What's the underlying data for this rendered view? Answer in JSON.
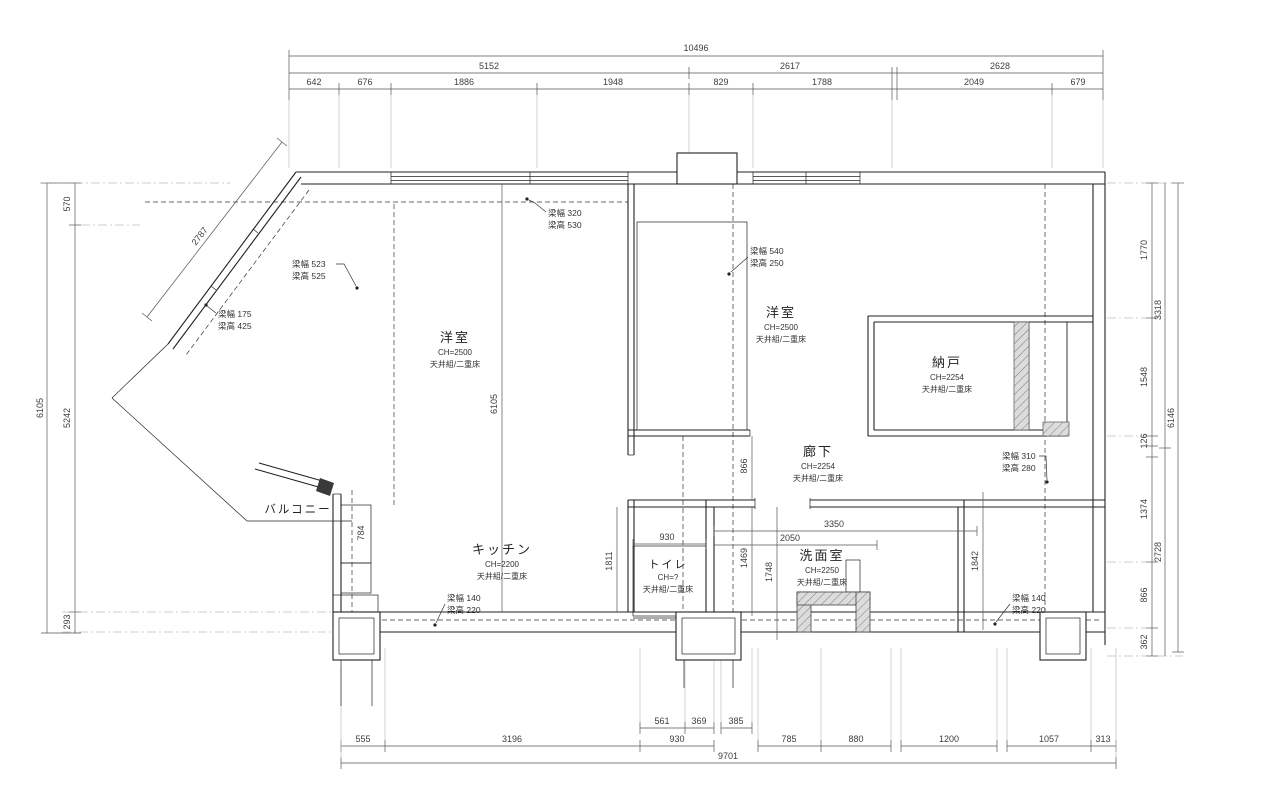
{
  "dims": {
    "top_total": "10496",
    "top2": [
      "5152",
      "2617",
      "2628"
    ],
    "top3": [
      "642",
      "676",
      "1886",
      "1948",
      "829",
      "1788",
      "2049",
      "679"
    ],
    "left_total": "6105",
    "left": [
      "570",
      "5242",
      "293"
    ],
    "right": [
      "1770",
      "1548",
      "126",
      "1374",
      "866",
      "362"
    ],
    "right_mid": [
      "3318",
      "2728"
    ],
    "right_total": "6146",
    "bot_sub": [
      "561",
      "369",
      "385"
    ],
    "bot": [
      "555",
      "3196",
      "930",
      "785",
      "880",
      "1200",
      "1057",
      "313"
    ],
    "bot_total": "9701",
    "interior": {
      "diag": "2787",
      "mid_v": "6105",
      "balc": "784",
      "kitchen": "1811",
      "hall": "866",
      "toilet_w": "930",
      "v1469": "1469",
      "v1748": "1748",
      "w2050": "2050",
      "w3350": "3350",
      "v1842": "1842"
    }
  },
  "rooms": {
    "yoshitsu_left": {
      "name": "洋室",
      "ch": "CH=2500",
      "spec": "天井組/二重床"
    },
    "yoshitsu_right": {
      "name": "洋室",
      "ch": "CH=2500",
      "spec": "天井組/二重床"
    },
    "nando": {
      "name": "納戸",
      "ch": "CH=2254",
      "spec": "天井組/二重床"
    },
    "rouka": {
      "name": "廊下",
      "ch": "CH=2254",
      "spec": "天井組/二重床"
    },
    "kitchen": {
      "name": "キッチン",
      "ch": "CH=2200",
      "spec": "天井組/二重床"
    },
    "toilet": {
      "name": "トイレ",
      "ch": "CH=?",
      "spec": "天井組/二重床"
    },
    "washroom": {
      "name": "洗面室",
      "ch": "CH=2250",
      "spec": "天井組/二重床"
    },
    "balcony": {
      "name": "バルコニー"
    }
  },
  "beams": [
    {
      "width": "梁幅 523",
      "height": "梁高 525"
    },
    {
      "width": "梁幅 175",
      "height": "梁高 425"
    },
    {
      "width": "梁幅 320",
      "height": "梁高 530"
    },
    {
      "width": "梁幅 540",
      "height": "梁高 250"
    },
    {
      "width": "梁幅 140",
      "height": "梁高 220"
    },
    {
      "width": "梁幅 310",
      "height": "梁高 280"
    },
    {
      "width": "梁幅 140",
      "height": "梁高 220"
    }
  ],
  "colors": {
    "wall": "#222222",
    "dimension": "#555555",
    "hatch_fill": "#dcdcdc",
    "text": "#3c3c46"
  }
}
